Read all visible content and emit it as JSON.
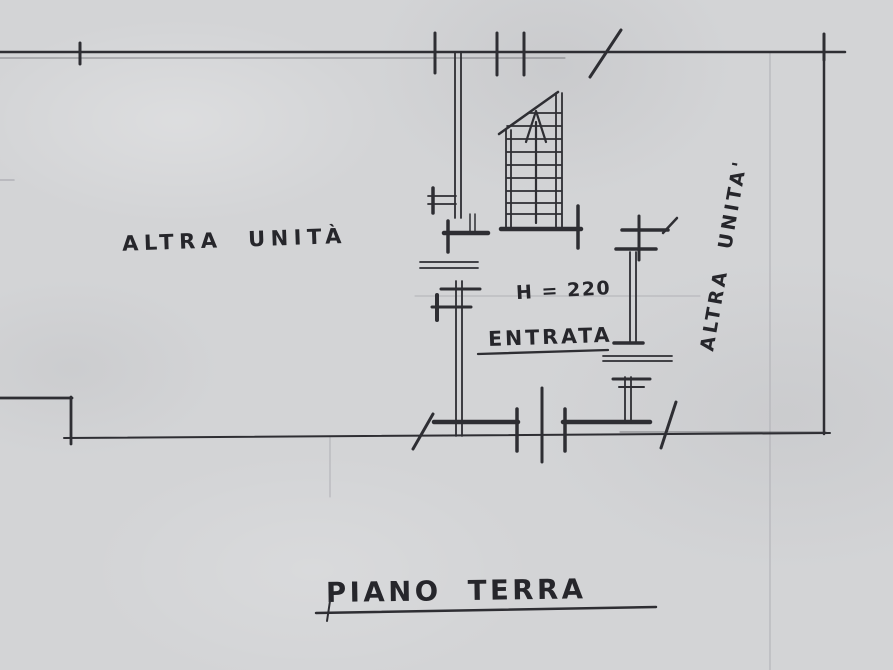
{
  "labels": {
    "left_unit": "ALTRA  UNITÀ",
    "height_note": "H = 220",
    "entrance": "ENTRATA",
    "right_unit": "ALTRA  UNITA'",
    "title": "PIANO  TERRA"
  },
  "colors": {
    "paper": "#d3d4d6",
    "ink": "#2e2e33",
    "faint_line": "#b2b2b7"
  }
}
